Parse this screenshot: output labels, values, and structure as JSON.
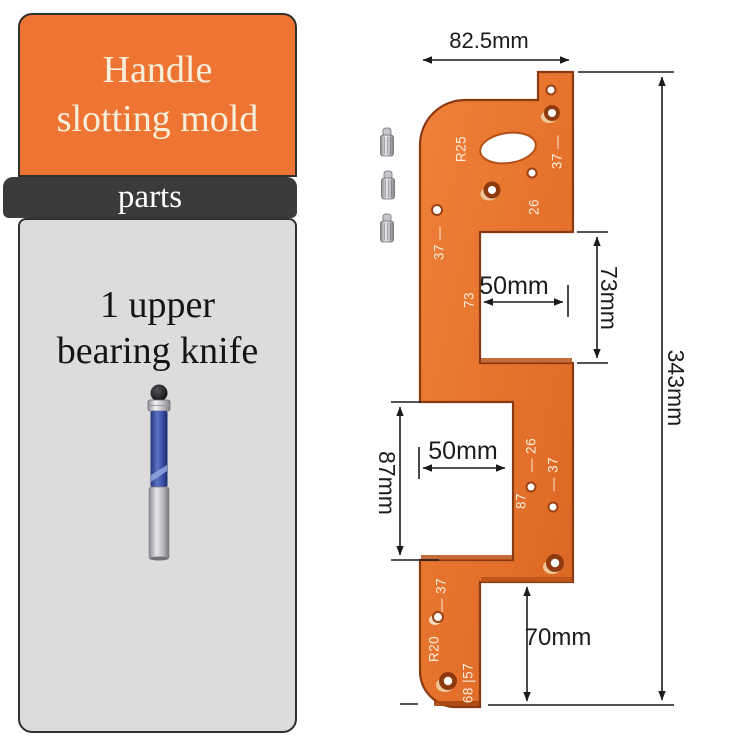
{
  "panel": {
    "title_line1": "Handle",
    "title_line2": "slotting mold",
    "band_label": "parts",
    "part_name_line1": "1 upper",
    "part_name_line2": "bearing knife"
  },
  "drawing": {
    "dimensions": {
      "top_width": "82.5mm",
      "overall_height": "343mm",
      "notch1_height": "73mm",
      "notch1_depth": "50mm",
      "notch2_height": "87mm",
      "notch2_depth": "50mm",
      "bottom_offset": "70mm"
    },
    "plate_markings": {
      "r25": "R25",
      "m37_top_right": "37 —",
      "m26_top": "26",
      "m37_top_left": "37 —",
      "m73": "73",
      "m26_mid": "— 26",
      "m37_mid": "— 37",
      "m87": "87",
      "m37_bottom": "— 37",
      "r20": "R20",
      "m68_57": "68 |57"
    }
  },
  "colors": {
    "header_orange": "#ee7434",
    "plate_orange": "#e5762f",
    "band_dark": "#3b3b3d",
    "panel_gray": "#dcdcdc",
    "bit_blue": "#3a56b0",
    "line_black": "#1b1b1b"
  }
}
